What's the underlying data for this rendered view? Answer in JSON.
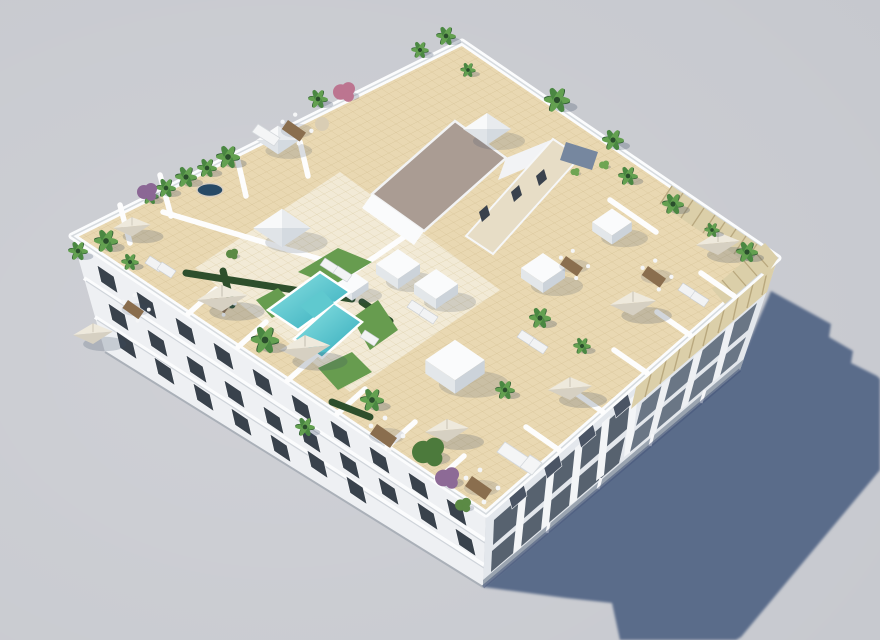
{
  "meta": {
    "type": "architectural-3d-render",
    "alt_text": "Aerial isometric 3D render of a white apartment block with a rooftop terrace: turquoise pool, artificial lawns, palm trees, cream parasols, dining sets, skylights and a central stair core, casting a long blue-gray shadow on plain gray ground"
  },
  "scene": {
    "colors": {
      "background": "#c6c8ce",
      "ground_shadow": "#5a6c8a",
      "facade_sw": "#eef0f3",
      "facade_se": "#e3e7ec",
      "window_glass": "#39424c",
      "balcony_recess": "#57626f",
      "base_strip": "#9aa4b0",
      "roof_tile": "#e9d8b2",
      "roof_tile_light": "#f2ead6",
      "grout": "#d9c69a",
      "parapet": "#fbfcfd",
      "pergola": "#dbcfa9",
      "pergola_stripe": "#b9a87e",
      "gravel_roof": "#aa9c93",
      "core_wall": "#e7ddc6",
      "pool_light": "#8ee4e4",
      "pool_deep": "#31a9ba",
      "lawn": "#679c4f",
      "hedge": "#2e4f2c",
      "palm_dark": "#2f5b33",
      "palm_mid": "#4a8742",
      "palm_light": "#63a050",
      "bush_purple": "#8d6a96",
      "bush_pink": "#bc7590",
      "tree_green": "#4c7a3c",
      "umbrella_top": "#eee9dc",
      "umbrella_shade": "#d6d0c2",
      "wood": "#8a6e4e",
      "jacuzzi_water": "#274a66"
    },
    "inventory": {
      "buildings": 1,
      "rooftop_pools": 1,
      "jacuzzis": 1,
      "parasols": 8,
      "skylight_cubes": 6,
      "skylight_pyramids": 3,
      "palm_trees": 23,
      "flowering_bushes": 4,
      "lawn_patches": 4,
      "dining_sets": 7,
      "sun_loungers": 11
    }
  }
}
